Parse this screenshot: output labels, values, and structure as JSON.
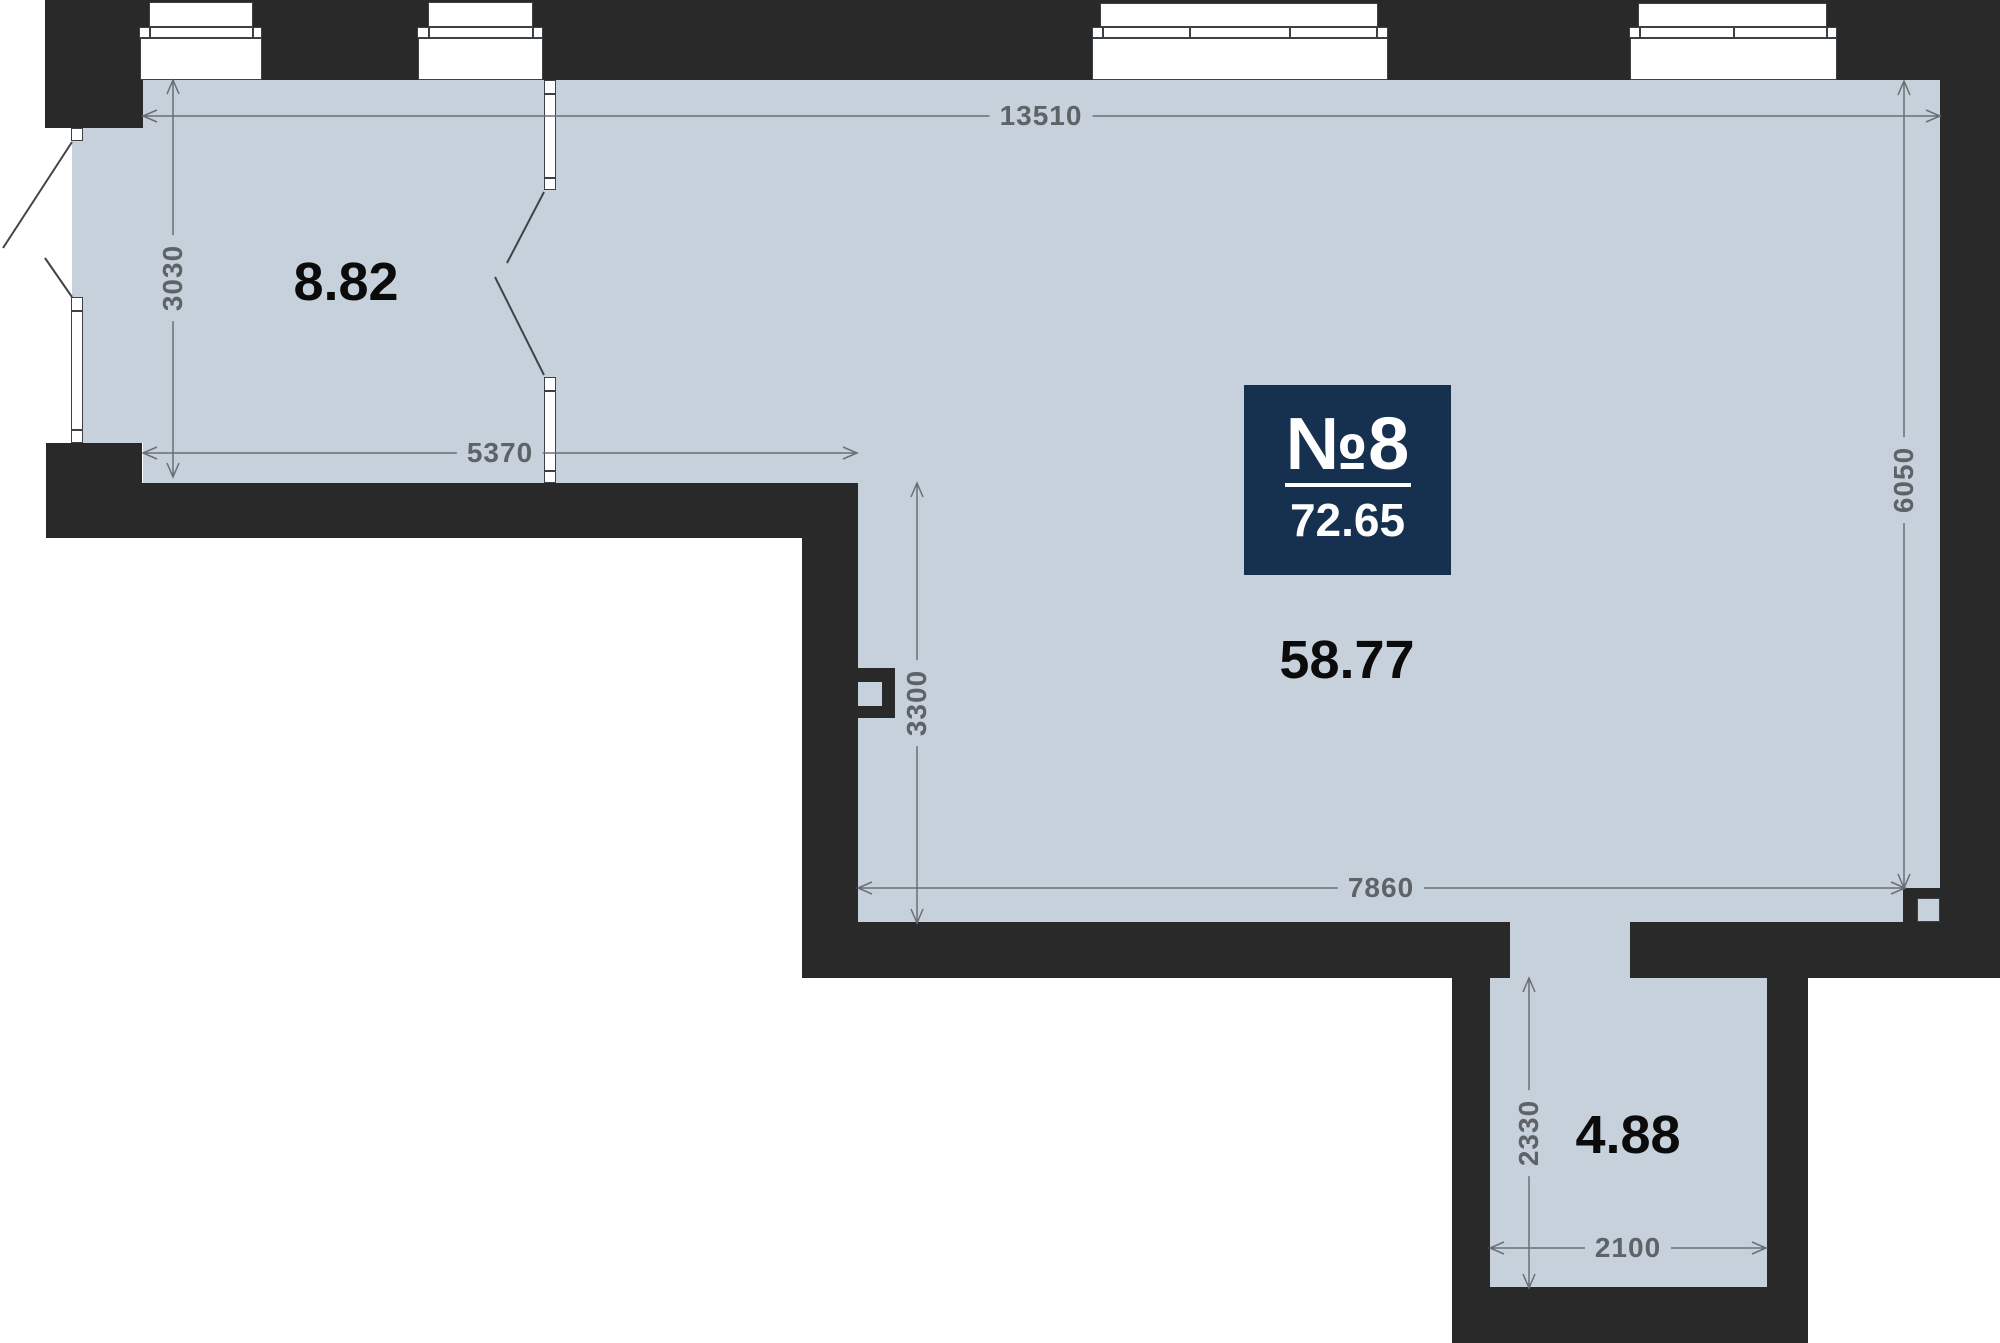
{
  "plan": {
    "unit_badge": {
      "number": "№8",
      "total_area": "72.65"
    },
    "rooms": {
      "room1_area": "8.82",
      "main_area": "58.77",
      "hall_area": "4.88"
    },
    "dimensions": {
      "top_width": "13510",
      "room1_height": "3030",
      "room1_width": "5370",
      "step_height": "3300",
      "right_height": "6050",
      "main_width": "7860",
      "hall_height": "2330",
      "hall_width": "2100"
    },
    "colors": {
      "wall": "#292929",
      "floor": "#c7d1db",
      "badge_background": "#163050",
      "badge_text": "#ffffff",
      "dimension_text": "#5e6367",
      "room_label_text": "#0b0b0b"
    }
  }
}
